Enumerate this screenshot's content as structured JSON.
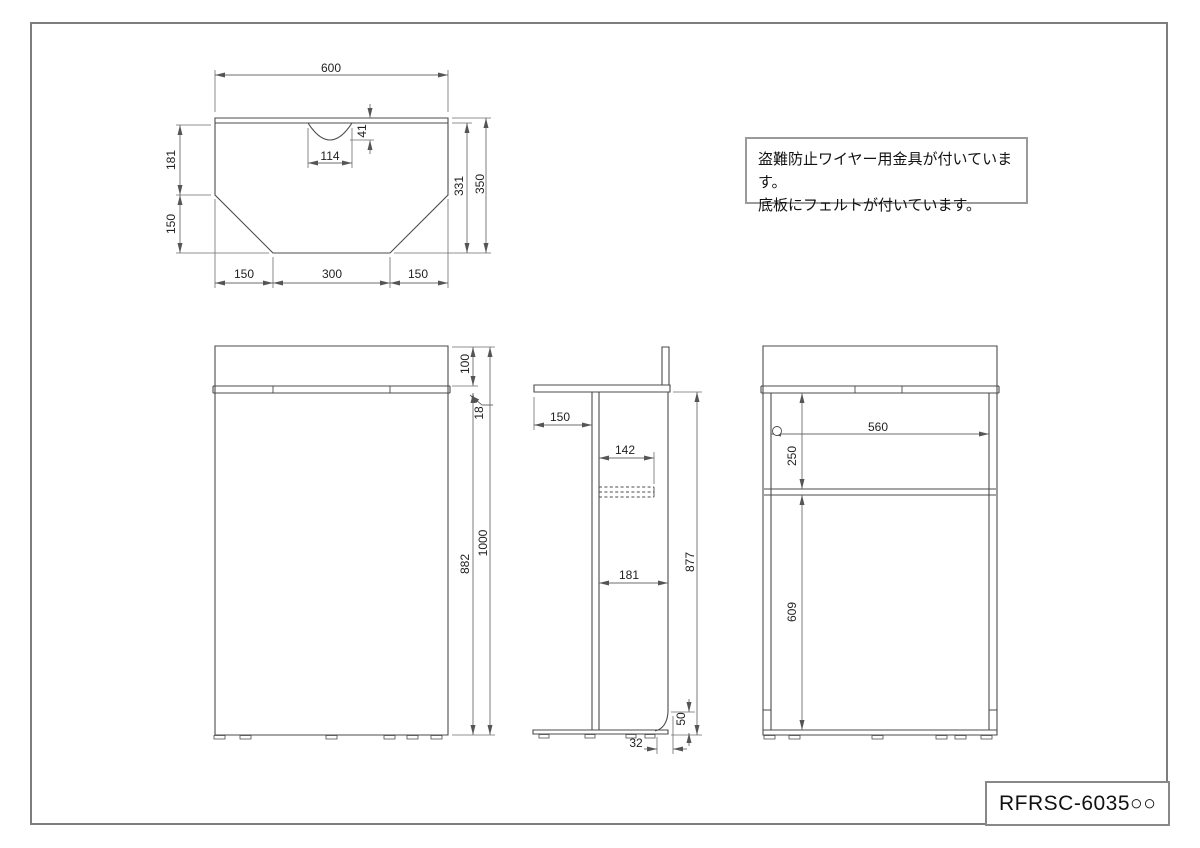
{
  "colors": {
    "geometry_line": "#4b4b4b",
    "dimension_line": "#6e6e6e",
    "border": "#7d7d7d"
  },
  "note_box": {
    "line1": "盗難防止ワイヤー用金具が付いています。",
    "line2": "底板にフェルトが付いています。"
  },
  "title_block": {
    "part_number": "RFRSC-6035○○"
  },
  "views": {
    "top": {
      "label": "top-view",
      "dims": {
        "width": "600",
        "notch_depth": "41",
        "notch_width": "114",
        "left_upper": "181",
        "left_lower": "150",
        "right_inner": "331",
        "right_outer": "350",
        "bottom_left": "150",
        "bottom_center": "300",
        "bottom_right": "150"
      }
    },
    "front": {
      "label": "front-view",
      "dims": {
        "panel_height": "100",
        "top_thickness": "18",
        "body_height": "882",
        "total_height": "1000"
      }
    },
    "side": {
      "label": "side-view",
      "dims": {
        "overhang": "150",
        "shelf_depth": "142",
        "body_depth": "181",
        "height": "877",
        "cutout_height": "50",
        "cutout_depth": "32"
      }
    },
    "back": {
      "label": "back-view",
      "dims": {
        "inner_width": "560",
        "shelf_top": "250",
        "shelf_bottom": "609"
      }
    }
  }
}
